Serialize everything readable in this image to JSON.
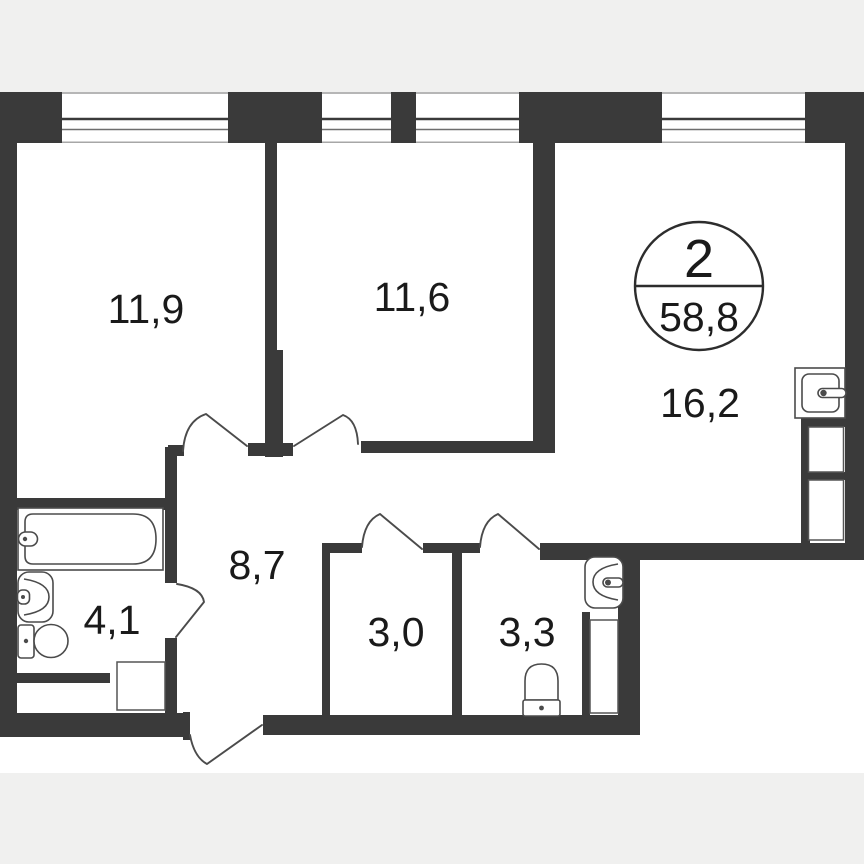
{
  "plan_type": "apartment-floor-plan",
  "colors": {
    "background": "#f0f0ef",
    "canvas": "#ffffff",
    "wall": "#3a3a3a",
    "fixture_line": "#4b4b4b",
    "text": "#1a1a1a"
  },
  "badge": {
    "room_count": "2",
    "total_area": "58,8"
  },
  "rooms": [
    {
      "id": "room-left",
      "area": "11,9"
    },
    {
      "id": "room-middle",
      "area": "11,6"
    },
    {
      "id": "kitchen-living",
      "area": "16,2"
    },
    {
      "id": "hallway",
      "area": "8,7"
    },
    {
      "id": "bathroom",
      "area": "4,1"
    },
    {
      "id": "wc-small",
      "area": "3,0"
    },
    {
      "id": "wc-large",
      "area": "3,3"
    }
  ]
}
